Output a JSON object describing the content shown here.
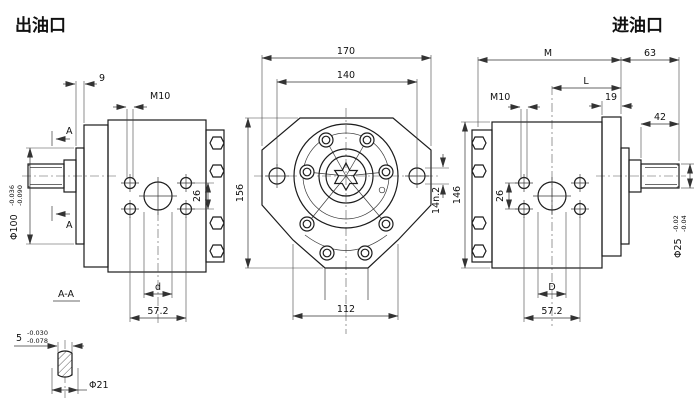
{
  "drawing": {
    "titles": {
      "outlet": "出油口",
      "inlet": "进油口"
    },
    "left_view": {
      "dim_pilot_depth": "9",
      "thread_callout": "M10",
      "dim_pilot_dia": "Φ100",
      "pilot_tol_upper": "-0.036",
      "pilot_tol_lower": "-0.090",
      "dim_hole_spacing_v": "26",
      "dim_port_dia": "d",
      "dim_hole_spacing_h": "57.2",
      "section_arrow_label": "A"
    },
    "front_view": {
      "dim_overall_width": "170",
      "dim_slot_spacing": "140",
      "dim_overall_height": "156",
      "dim_slot_width": "14n.2",
      "dim_bottom_width": "112"
    },
    "right_view": {
      "dim_overall_length": "M",
      "dim_to_center": "L",
      "dim_shaft_extension": "63",
      "dim_flange_thickness": "19",
      "dim_shaft_length": "42",
      "thread_callout": "M10",
      "dim_hole_spacing_v": "26",
      "dim_overall_height": "146",
      "dim_shaft_dia": "Φ25",
      "shaft_tol_upper": "-0.02",
      "shaft_tol_lower": "-0.04",
      "dim_port_dia": "D",
      "dim_hole_spacing_h": "57.2"
    },
    "section_view": {
      "label": "A-A",
      "dim_key_width": "5",
      "key_tol_upper": "-0.030",
      "key_tol_lower": "-0.078",
      "dim_shaft_dia": "Φ21"
    }
  }
}
